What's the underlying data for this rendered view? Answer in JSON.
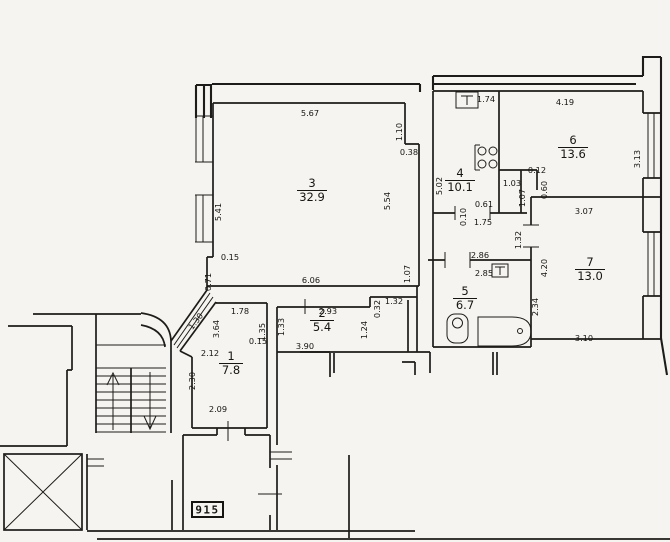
{
  "plan": {
    "stamp": "915",
    "rooms": [
      {
        "number": "1",
        "area": "7.8",
        "x": 231,
        "y": 360
      },
      {
        "number": "2",
        "area": "5.4",
        "x": 322,
        "y": 317
      },
      {
        "number": "3",
        "area": "32.9",
        "x": 312,
        "y": 187
      },
      {
        "number": "4",
        "area": "10.1",
        "x": 460,
        "y": 177
      },
      {
        "number": "5",
        "area": "6.7",
        "x": 465,
        "y": 295
      },
      {
        "number": "6",
        "area": "13.6",
        "x": 573,
        "y": 144
      },
      {
        "number": "7",
        "area": "13.0",
        "x": 590,
        "y": 266
      }
    ],
    "dimensions": [
      {
        "text": "5.67",
        "x": 310,
        "y": 116,
        "rot": 0
      },
      {
        "text": "1.10",
        "x": 402,
        "y": 132,
        "rot": -90
      },
      {
        "text": "0.38",
        "x": 409,
        "y": 155,
        "rot": 0
      },
      {
        "text": "5.41",
        "x": 221,
        "y": 212,
        "rot": -90
      },
      {
        "text": "5.54",
        "x": 390,
        "y": 201,
        "rot": -90
      },
      {
        "text": "0.15",
        "x": 230,
        "y": 260,
        "rot": 0
      },
      {
        "text": "0.71",
        "x": 211,
        "y": 282,
        "rot": -90
      },
      {
        "text": "6.06",
        "x": 311,
        "y": 283,
        "rot": 0
      },
      {
        "text": "1.07",
        "x": 410,
        "y": 274,
        "rot": -90
      },
      {
        "text": "1.74",
        "x": 486,
        "y": 102,
        "rot": 0
      },
      {
        "text": "5.02",
        "x": 442,
        "y": 186,
        "rot": -90
      },
      {
        "text": "4.19",
        "x": 565,
        "y": 105,
        "rot": 0
      },
      {
        "text": "3.13",
        "x": 640,
        "y": 159,
        "rot": -90
      },
      {
        "text": "0.12",
        "x": 537,
        "y": 173,
        "rot": 0
      },
      {
        "text": "1.03",
        "x": 512,
        "y": 186,
        "rot": 0
      },
      {
        "text": "0.60",
        "x": 547,
        "y": 190,
        "rot": -90
      },
      {
        "text": "1.07",
        "x": 525,
        "y": 198,
        "rot": -90
      },
      {
        "text": "0.61",
        "x": 484,
        "y": 207,
        "rot": 0
      },
      {
        "text": "0.10",
        "x": 466,
        "y": 217,
        "rot": -90
      },
      {
        "text": "1.75",
        "x": 483,
        "y": 225,
        "rot": 0
      },
      {
        "text": "3.07",
        "x": 584,
        "y": 214,
        "rot": 0
      },
      {
        "text": "1.32",
        "x": 521,
        "y": 240,
        "rot": -90
      },
      {
        "text": "2.86",
        "x": 480,
        "y": 258,
        "rot": 0
      },
      {
        "text": "2.85",
        "x": 484,
        "y": 276,
        "rot": 0
      },
      {
        "text": "4.20",
        "x": 547,
        "y": 268,
        "rot": -90
      },
      {
        "text": "2.34",
        "x": 538,
        "y": 307,
        "rot": -90
      },
      {
        "text": "3.10",
        "x": 584,
        "y": 341,
        "rot": 0
      },
      {
        "text": "1.78",
        "x": 240,
        "y": 314,
        "rot": 0
      },
      {
        "text": "2.93",
        "x": 328,
        "y": 314,
        "rot": 0
      },
      {
        "text": "1.32",
        "x": 394,
        "y": 304,
        "rot": 0
      },
      {
        "text": "0.32",
        "x": 380,
        "y": 309,
        "rot": -90
      },
      {
        "text": "1.24",
        "x": 367,
        "y": 330,
        "rot": -90
      },
      {
        "text": "1.35",
        "x": 265,
        "y": 332,
        "rot": -90
      },
      {
        "text": "1.33",
        "x": 284,
        "y": 327,
        "rot": -90
      },
      {
        "text": "3.90",
        "x": 305,
        "y": 349,
        "rot": 0
      },
      {
        "text": "0.15",
        "x": 258,
        "y": 344,
        "rot": 0
      },
      {
        "text": "3.64",
        "x": 219,
        "y": 329,
        "rot": -90
      },
      {
        "text": "2.12",
        "x": 210,
        "y": 356,
        "rot": 0
      },
      {
        "text": "1.30",
        "x": 198,
        "y": 323,
        "rot": -52
      },
      {
        "text": "2.30",
        "x": 195,
        "y": 381,
        "rot": -90
      },
      {
        "text": "2.09",
        "x": 218,
        "y": 412,
        "rot": 0
      }
    ]
  }
}
